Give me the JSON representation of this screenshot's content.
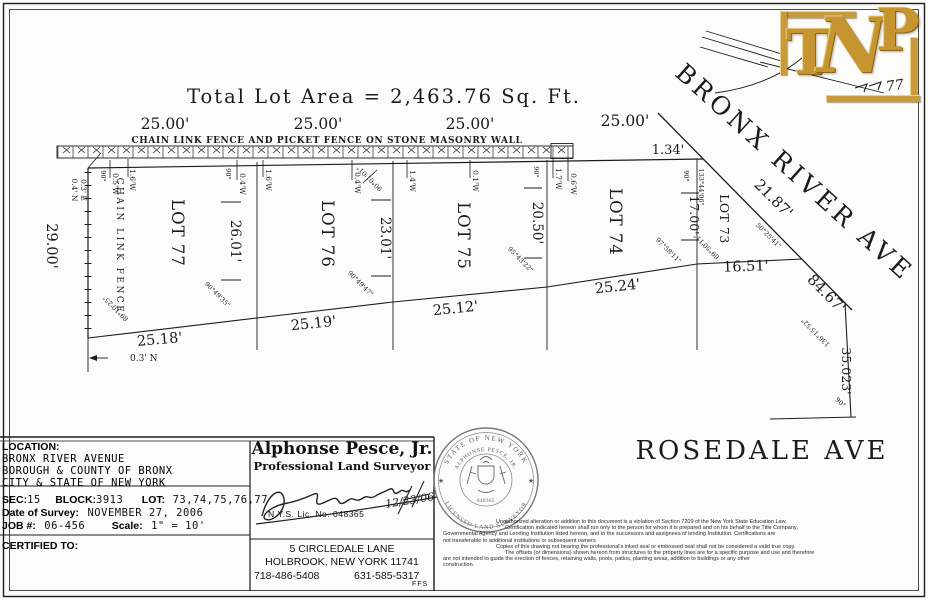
{
  "drawing": {
    "title": "Total Lot Area  =  2,463.76 Sq. Ft.",
    "fence_note": "CHAIN LINK FENCE AND PICKET FENCE ON STONE MASONRY WALL",
    "bronx_ave": "BRONX RIVER AVE",
    "rosedale_ave": "ROSEDALE AVE",
    "frontage": [
      "25.00'",
      "25.00'",
      "25.00'",
      "25.00'"
    ],
    "lot73_front": "1.34'",
    "lots": [
      "LOT 77",
      "LOT 76",
      "LOT 75",
      "LOT 74",
      "LOT 73"
    ],
    "depths": [
      "29.00'",
      "26.01'",
      "23.01'",
      "20.50'",
      "17.00'"
    ],
    "east_dim": "35.023'",
    "rear": [
      "25.18'",
      "25.19'",
      "25.12'",
      "25.24'",
      "16.51'"
    ],
    "bronx_dims": [
      "21.87'",
      "84.67'"
    ],
    "chain_link": "CHAIN LINK FENCE",
    "north_offset": "0.3' N",
    "corner_offsets": [
      "0.4' N",
      "0.3' E"
    ],
    "offsets": [
      "0.5'W",
      "1.6'W",
      "0.4'W",
      "1.6'W",
      "0.4'W",
      "1.4'W",
      "0.1'W",
      "1.7'W",
      "0.6'W"
    ],
    "angles": {
      "ninety": "90°",
      "a1": "90°49'35\"",
      "a2": "90°49'47\"",
      "a3": "95°43'22\"",
      "a4": "97°58'11\"",
      "a5": "69°50'11\"",
      "a6": "89°10'25\"",
      "a7": "50°25'41\"",
      "a8": "133°44'06\"",
      "a9": "136°15'52\"",
      "a10": "90°01'01\""
    }
  },
  "logo": {
    "t": "T",
    "n": "N",
    "p": "P",
    "scribble": "77"
  },
  "title_block": {
    "location_label": "LOCATION:",
    "location_lines": [
      "BRONX RIVER AVENUE",
      "BOROUGH & COUNTY OF BRONX",
      "CITY & STATE OF NEW YORK"
    ],
    "sec_label": "SEC:",
    "sec": "15",
    "block_label": "BLOCK:",
    "block": "3913",
    "lot_label": "LOT:",
    "lot": "73,74,75,76,77",
    "date_label": "Date of Survey:",
    "date": "NOVEMBER 27, 2006",
    "job_label": "JOB #:",
    "job": "06-456",
    "scale_label": "Scale:",
    "scale": "1\" = 10'",
    "certified_label": "CERTIFIED TO:"
  },
  "surveyor": {
    "name": "Alphonse Pesce, Jr.",
    "title": "Professional Land Surveyor",
    "lic": "N.Y.S. Lic. No. 048365",
    "sign_date": "12/23/06",
    "address1": "5 CIRCLEDALE LANE",
    "address2": "HOLBROOK, NEW YORK 11741",
    "phone1": "718-486-5408",
    "phone2": "631-585-5317",
    "initials": "FFS"
  },
  "seal": {
    "top": "STATE OF NEW YORK",
    "name": "ALPHONSE PESCE, JR.",
    "bottom": "LICENSED LAND SURVEYOR",
    "lic": "048365",
    "star": "★"
  },
  "disclaimer": {
    "lines": [
      "Unauthorized alteration or addition to this document is a violation of Section 7209 of the New York State Education Law.",
      "Certification indicated hereon shall run only to the person for whom it is prepared and on his behalf to the Title Company,",
      "Governmental Agency and Lending Institution listed hereon, and to the successors and assignees of lending Institution. Certifications are",
      "not transferable to additional institutions or subsequent owners.",
      "Copies of this drawing not bearing the professional's inked seal or embossed seal shall not be considered a valid true copy.",
      "The offsets (or dimensions) shown hereon from structures to the property lines are for a specific purpose and use and therefore",
      "are not intended to guide the erection of fences, retaining walls, pools, patios, planting areas, addition to buildings or any other",
      "construction."
    ]
  }
}
